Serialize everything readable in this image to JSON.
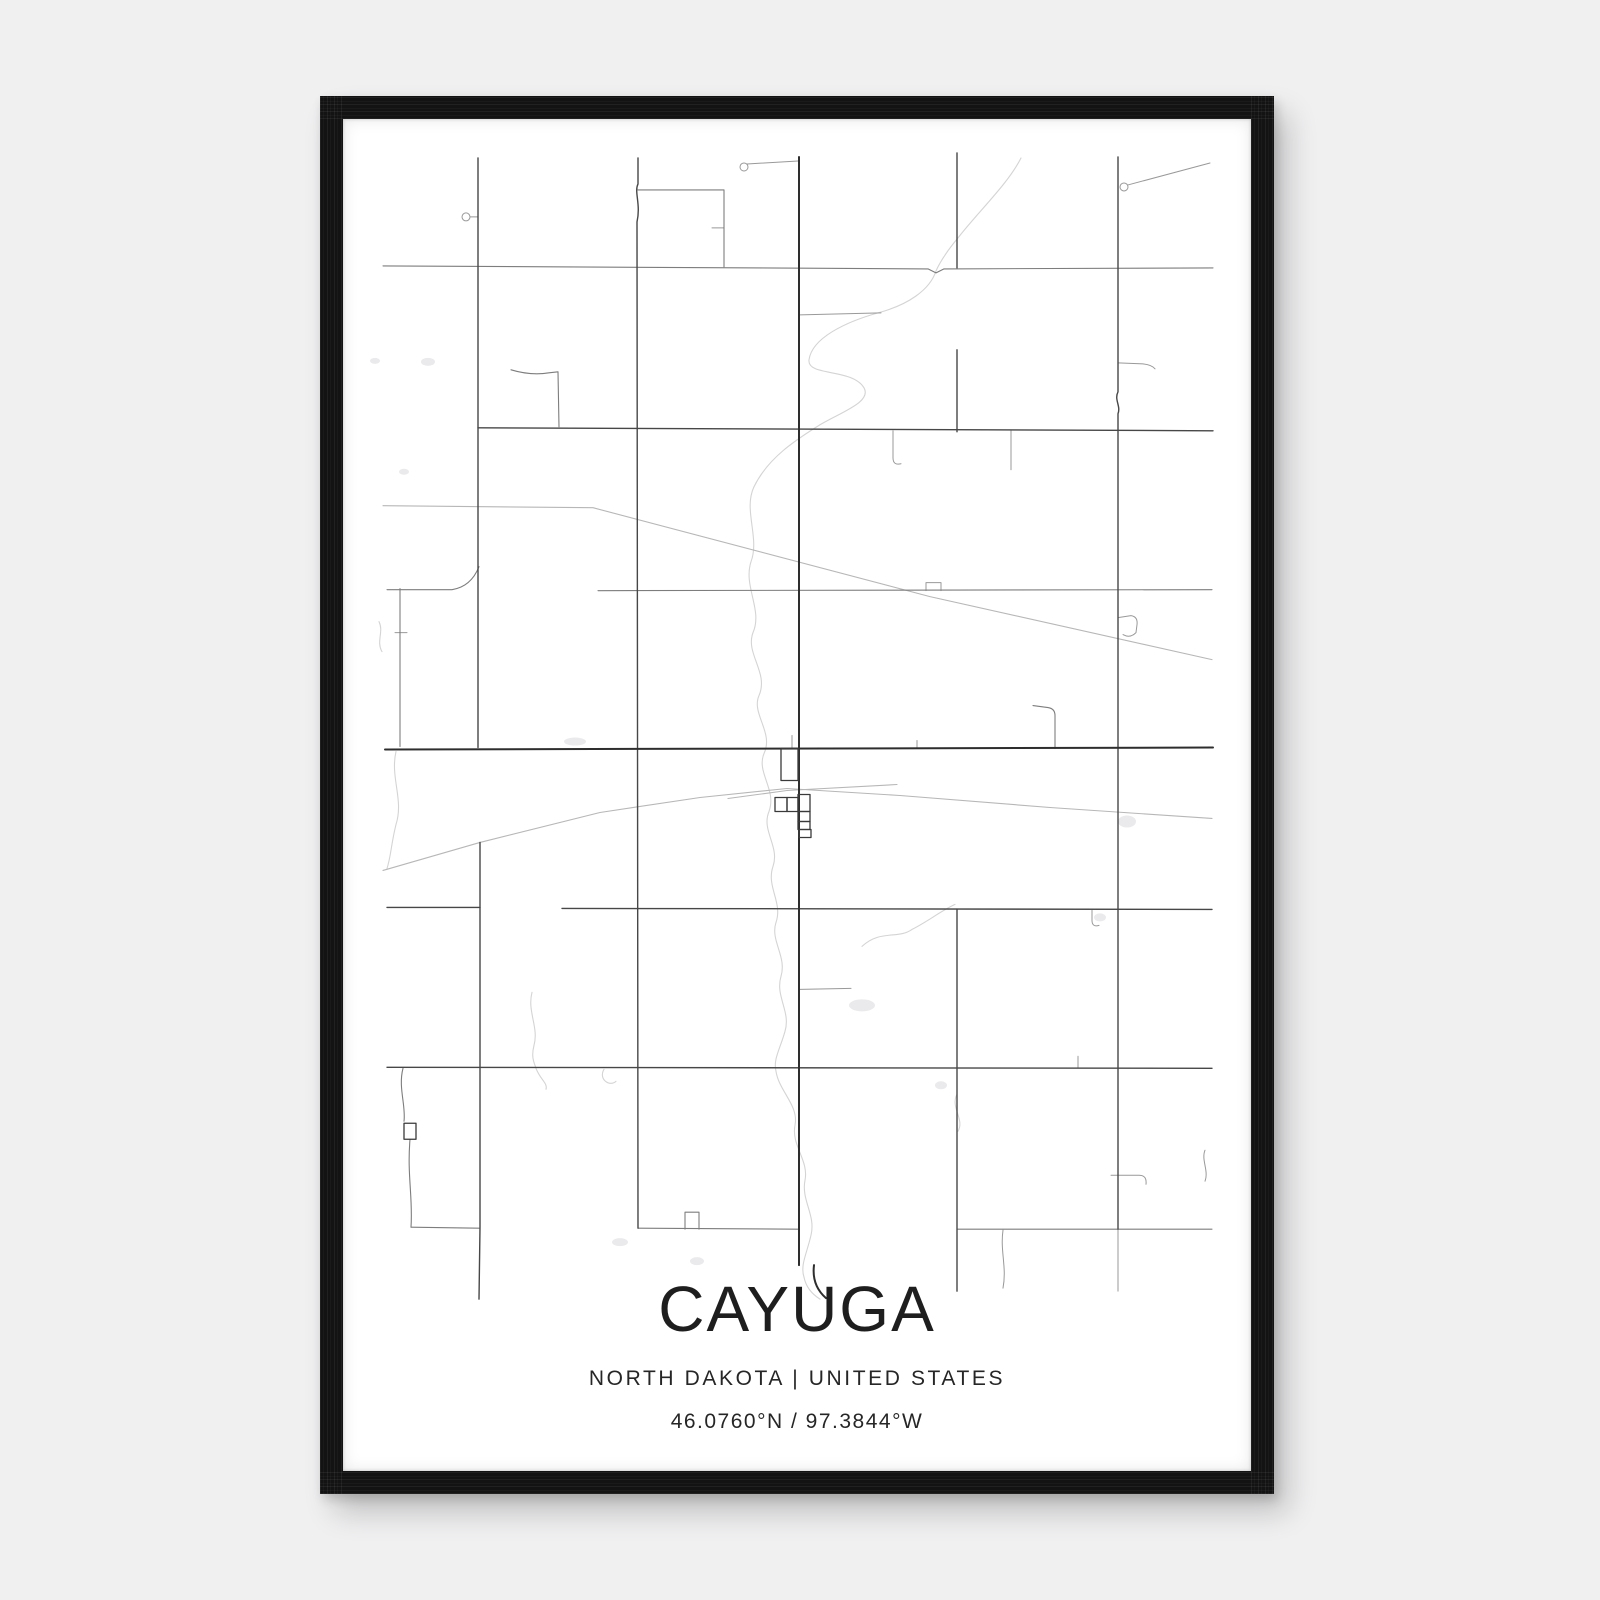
{
  "poster": {
    "title": "CAYUGA",
    "subtitle": "NORTH DAKOTA | UNITED STATES",
    "coordinates": "46.0760°N / 97.3844°W"
  },
  "colors": {
    "page_background": "#f0f0f1",
    "frame": "#131313",
    "paper": "#ffffff",
    "road_major": "#2e2e2e",
    "road_secondary": "#474747",
    "road_medium": "#7d7d7d",
    "road_minor": "#999999",
    "railway": "#b7b7b7",
    "stream": "#d4d4d4",
    "water_fill": "#eaeaec",
    "title_text": "#1e1e1e"
  },
  "map": {
    "layers": [
      {
        "name": "water-ponds",
        "kind": "fill",
        "fill": "#eaeaec",
        "ellipses": [
          [
            428,
            362,
            7,
            4
          ],
          [
            375,
            361,
            5,
            3
          ],
          [
            404,
            472,
            5,
            3
          ],
          [
            575,
            742,
            11,
            4
          ],
          [
            862,
            1006,
            13,
            6
          ],
          [
            1127,
            822,
            9,
            6
          ],
          [
            1100,
            918,
            6,
            4
          ],
          [
            620,
            1243,
            8,
            4
          ],
          [
            697,
            1262,
            7,
            4
          ],
          [
            941,
            1086,
            6,
            4
          ]
        ]
      },
      {
        "name": "streams",
        "stroke": "#d4d4d4",
        "width": 1.1,
        "paths": [
          "M1021,158 C1008,184 978,212 958,238 C948,250 941,260 936,271 C930,290 908,305 878,313 C846,322 812,338 809,360 C807,377 852,368 864,388 C872,402 842,412 820,425 C796,440 768,458 754,487 C743,510 760,538 751,562 C743,587 763,610 753,633 C745,654 769,673 759,696 C751,714 774,733 764,754 C756,773 777,790 769,812 C761,831 780,847 773,867 C766,887 783,903 776,923 C770,941 787,957 781,977 C775,997 791,1012 785,1032 C780,1050 773,1060 776,1072 C779,1092 799,1106 795,1126 C791,1146 809,1161 805,1181 C801,1201 816,1216 811,1236 C807,1254 800,1266 804,1278",
          "M804,1278 C806,1288 812,1295 820,1300",
          "M396,752 C390,778 404,800 396,825 C391,845 391,857 387,869",
          "M379,622 C384,632 376,642 382,652",
          "M532,993 C527,1012 539,1028 534,1046 C531,1058 534,1063 536,1069",
          "M536,1069 C540,1080 548,1084 546,1090",
          "M604,1070 C598,1080 610,1088 616,1082",
          "M862,947 C880,930 898,940 912,930 C928,922 940,912 955,905",
          "M957,1095 C950,1108 965,1120 958,1132"
        ]
      },
      {
        "name": "railways",
        "stroke": "#b7b7b7",
        "width": 1.1,
        "paths": [
          "M383,871 L480,843 L600,813 L700,798 L787,789 L900,796 L1050,808 L1212,819",
          "M728,799 L787,791 L897,785",
          "M383,506 L593,508 L930,597 L1212,660"
        ]
      },
      {
        "name": "roads-minor",
        "stroke": "#999999",
        "width": 1,
        "paths": [
          "M712,228 L724,228",
          "M747,164 L798,161",
          "M1128,185 L1210,163",
          "M800,315 L881,313",
          "M893,431 L893,458 Q893,466 901,464",
          "M1011,431 L1011,470",
          "M1118,363 L1143,364 Q1152,365 1155,369",
          "M1118,618 L1131,616 Q1138,617 1137,625 L1136,633 Q1130,639 1123,635",
          "M1078,1057 L1078,1068",
          "M1092,911 L1092,921 Q1092,928 1099,926",
          "M1111,1176 L1139,1176 Q1147,1176 1146,1185",
          "M1205,1151 C1201,1161 1209,1171 1205,1182",
          "M917,741 L917,749",
          "M792,736 L792,749",
          "M395,633 L407,633",
          "M470,217 L478,217",
          "M800,990 L851,989",
          "M926,591 L926,583 L941,583 L941,591",
          "M1003,1231 C1000,1252 1007,1268 1003,1289",
          "M1118,1230 L1118,1292"
        ],
        "circles": [
          [
            466,
            217,
            4
          ],
          [
            744,
            167,
            4
          ],
          [
            1124,
            187,
            4
          ]
        ]
      },
      {
        "name": "roads-medium",
        "stroke": "#7d7d7d",
        "width": 1.1,
        "paths": [
          "M383,266 L928,269 L936,273 L944,269 L1213,268",
          "M387,590 L452,590 Q471,587 479,567",
          "M598,591 L1212,590",
          "M638,1229 L798,1230",
          "M957,1230 L1212,1230",
          "M638,190 L724,190 L724,267",
          "M511,370 Q531,376 549,373 L558,372 L559,427",
          "M400,589 L400,747",
          "M403,1069 C398,1088 406,1106 404,1122",
          "M410,1140 C407,1176 413,1198 411,1228",
          "M411,1228 L479,1229",
          "M1033,706 L1048,708 Q1055,709 1055,716 L1055,749",
          "M685,1230 L685,1213 L699,1213 L699,1230"
        ]
      },
      {
        "name": "roads-secondary",
        "stroke": "#474747",
        "width": 1.4,
        "paths": [
          "M478,158 L478,748",
          "M480,843 L480,1228 L479,1300",
          "M638,158 L638,184 C634,192 641,204 637,222 L638,1229",
          "M957,153 L957,268",
          "M957,350 L957,432",
          "M957,910 L957,1292",
          "M1118,157 L1118,392 C1114,400 1121,406 1118,414 L1118,1230",
          "M478,428 L1213,431",
          "M387,908 L480,908",
          "M562,909 L1212,910",
          "M387,1068 L1212,1069"
        ]
      },
      {
        "name": "roads-major",
        "stroke": "#2e2e2e",
        "width": 2,
        "paths": [
          "M799,157 L799,1266",
          "M814,1266 C812,1282 818,1292 826,1299",
          "M385,750 L1213,748"
        ]
      },
      {
        "name": "town-blocks",
        "stroke": "#3a3a3a",
        "width": 1.3,
        "rects": [
          [
            781,
            749,
            17,
            32
          ],
          [
            775,
            798,
            12,
            14
          ],
          [
            787,
            798,
            11,
            14
          ],
          [
            798,
            795,
            12,
            17
          ],
          [
            798,
            812,
            12,
            10
          ],
          [
            798,
            822,
            12,
            8
          ],
          [
            799,
            830,
            12,
            8
          ],
          [
            404,
            1124,
            12,
            16
          ]
        ]
      }
    ]
  }
}
